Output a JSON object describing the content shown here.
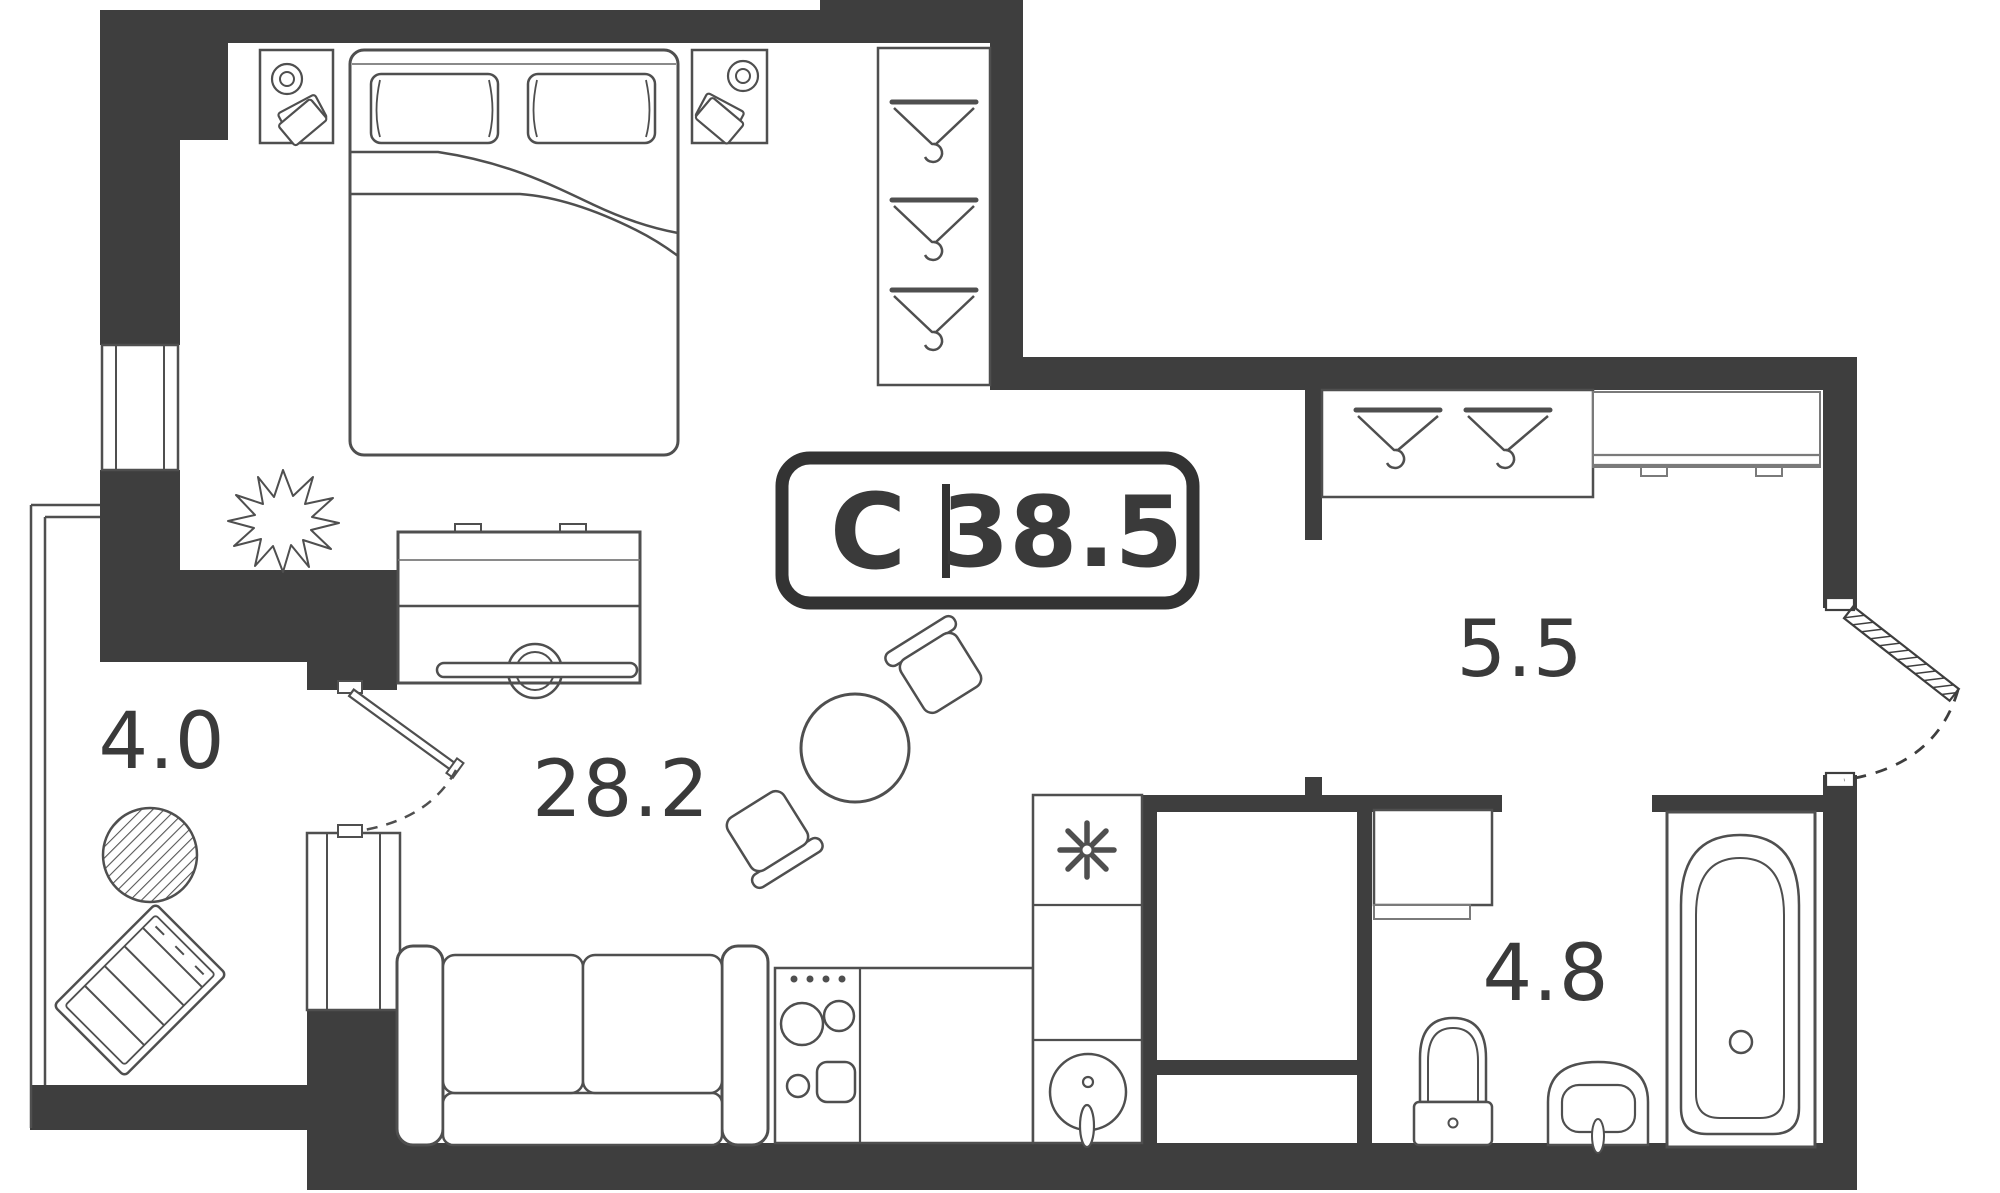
{
  "meta": {
    "drawing_type": "apartment floor plan (studio)",
    "area_unit": "m2"
  },
  "badge": {
    "letter": "С",
    "area": "38.5"
  },
  "rooms": {
    "living": {
      "name": "living-kitchen room",
      "label": "28.2"
    },
    "balcony": {
      "name": "balcony",
      "label": "4.0"
    },
    "hallway": {
      "name": "hallway",
      "label": "5.5"
    },
    "bathroom": {
      "name": "bathroom",
      "label": "4.8"
    }
  },
  "colors": {
    "wall": "#3e3e3e",
    "furniture": "#4f4f4f",
    "light_line": "#7a7a7a",
    "text": "#3a3a3a",
    "background": "#ffffff"
  }
}
